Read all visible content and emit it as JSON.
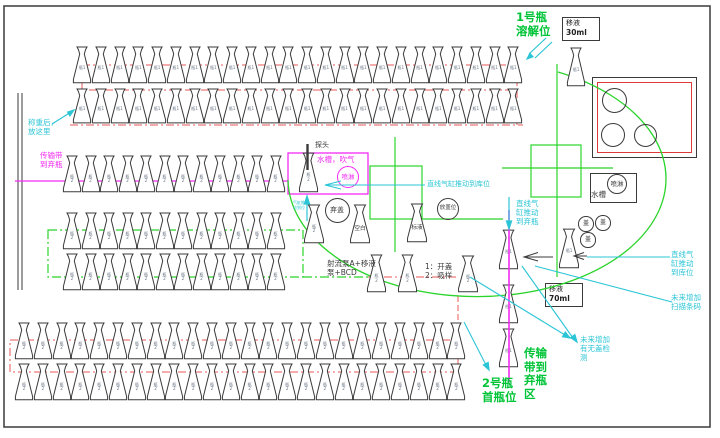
{
  "colors": {
    "black": "#3a3a3a",
    "red": "#ef8f8f",
    "red2": "#dd3a3a",
    "green": "#2bd42b",
    "greentext": "#00c437",
    "magenta": "#f32af3",
    "cyan": "#2cc5d6",
    "label": "#6a7585"
  },
  "frame": {
    "x": 4,
    "y": 6,
    "w": 706,
    "h": 421
  },
  "flask_rows": [
    {
      "name": "row-1",
      "x": 72,
      "y": 46,
      "count": 24,
      "pitch": 18.75,
      "fw": 20,
      "fh": 38,
      "label": "瓶1"
    },
    {
      "name": "row-2",
      "x": 72,
      "y": 88,
      "count": 24,
      "pitch": 18.75,
      "fw": 20,
      "fh": 36,
      "label": "瓶1"
    },
    {
      "name": "row-3",
      "x": 62,
      "y": 155,
      "count": 12,
      "pitch": 18.5,
      "fw": 20,
      "fh": 38,
      "label": "瓶\n2"
    },
    {
      "name": "row-4",
      "x": 62,
      "y": 212,
      "count": 12,
      "pitch": 18.5,
      "fw": 20,
      "fh": 38,
      "label": "瓶\n2"
    },
    {
      "name": "row-5",
      "x": 62,
      "y": 253,
      "count": 12,
      "pitch": 18.5,
      "fw": 20,
      "fh": 38,
      "label": "瓶\n2"
    },
    {
      "name": "row-6",
      "x": 14,
      "y": 322,
      "count": 24,
      "pitch": 18.8,
      "fw": 20,
      "fh": 38,
      "label": "瓶\n2"
    },
    {
      "name": "row-7",
      "x": 14,
      "y": 363,
      "count": 24,
      "pitch": 18.8,
      "fw": 20,
      "fh": 38,
      "label": "瓶\n2"
    }
  ],
  "flasks": [
    {
      "name": "flask-probe-station",
      "x": 298,
      "y": 152,
      "w": 21,
      "h": 41,
      "label": "瓶\n2"
    },
    {
      "name": "flask-wash-wait",
      "x": 303,
      "y": 204,
      "w": 22,
      "h": 40,
      "label": "瓶\n2"
    },
    {
      "name": "flask-blank",
      "x": 349,
      "y": 204,
      "w": 22,
      "h": 40,
      "label": "空白",
      "big": true
    },
    {
      "name": "flask-standard",
      "x": 406,
      "y": 203,
      "w": 22,
      "h": 40,
      "label": "标液",
      "big": true
    },
    {
      "name": "flask-carousel-1",
      "x": 366,
      "y": 254,
      "w": 21,
      "h": 39,
      "label": "瓶\n2"
    },
    {
      "name": "flask-carousel-2",
      "x": 397,
      "y": 254,
      "w": 21,
      "h": 39,
      "label": "瓶\n2"
    },
    {
      "name": "flask-open-aspirate",
      "x": 457,
      "y": 255,
      "w": 22,
      "h": 38,
      "label": "瓶\n2"
    },
    {
      "name": "flask-transfer",
      "x": 558,
      "y": 228,
      "w": 22,
      "h": 41,
      "label": "瓶1"
    },
    {
      "name": "flask-outfeed-1",
      "x": 498,
      "y": 229,
      "w": 21,
      "h": 41,
      "label": "瓶1"
    },
    {
      "name": "flask-outfeed-2",
      "x": 498,
      "y": 284,
      "w": 21,
      "h": 40,
      "label": "瓶1"
    },
    {
      "name": "flask-outfeed-3",
      "x": 498,
      "y": 328,
      "w": 21,
      "h": 40,
      "label": "瓶1"
    },
    {
      "name": "flask-dissolve",
      "x": 566,
      "y": 47,
      "w": 20,
      "h": 40,
      "label": "瓶1"
    }
  ],
  "boxes": [
    {
      "name": "cap-station-box",
      "x": 592,
      "y": 77,
      "w": 105,
      "h": 81,
      "border": "black",
      "bg": "#fff",
      "lines": []
    },
    {
      "name": "cap-station-inner",
      "x": 597,
      "y": 82,
      "w": 95,
      "h": 71,
      "border": "red2",
      "bg": "none",
      "lines": []
    },
    {
      "name": "water-tank-box",
      "x": 590,
      "y": 173,
      "w": 47,
      "h": 30,
      "border": "black",
      "bg": "#fff",
      "lines": []
    },
    {
      "name": "pipette-30ml-box",
      "x": 562,
      "y": 17,
      "w": 38,
      "h": 24,
      "border": "black",
      "bg": "#fff",
      "lines": [
        "移液",
        "30ml"
      ]
    },
    {
      "name": "pipette-70ml-box",
      "x": 545,
      "y": 283,
      "w": 38,
      "h": 24,
      "border": "black",
      "bg": "#fff",
      "lines": [
        "移液",
        "70ml"
      ]
    }
  ],
  "circles": [
    {
      "name": "discard-cap-circle",
      "cx": 337,
      "cy": 210,
      "r": 12.5,
      "label": "弃盖",
      "color": "black",
      "fs": 7
    },
    {
      "name": "place-cap-circle",
      "cx": 448,
      "cy": 209,
      "r": 11,
      "label": "放盖位",
      "color": "black",
      "fs": 5.6
    },
    {
      "name": "spray-circle-magenta",
      "cx": 348,
      "cy": 177,
      "r": 11,
      "label": "喷淋",
      "color": "magenta",
      "fs": 6.5
    },
    {
      "name": "spray-circle-black",
      "cx": 617,
      "cy": 184,
      "r": 10,
      "label": "喷淋",
      "color": "black",
      "fs": 6.5
    },
    {
      "name": "cap-circle-1",
      "cx": 586,
      "cy": 224,
      "r": 7.7,
      "label": "盖",
      "color": "black",
      "fs": 6
    },
    {
      "name": "cap-circle-2",
      "cx": 603,
      "cy": 223,
      "r": 7.7,
      "label": "盖",
      "color": "black",
      "fs": 6
    },
    {
      "name": "cap-circle-3",
      "cx": 588,
      "cy": 240,
      "r": 7.7,
      "label": "盖",
      "color": "black",
      "fs": 6
    },
    {
      "name": "station-circle-1",
      "cx": 614,
      "cy": 100,
      "r": 12.5,
      "label": "",
      "color": "black",
      "fs": 6
    },
    {
      "name": "station-circle-2",
      "cx": 613,
      "cy": 135,
      "r": 12,
      "label": "",
      "color": "black",
      "fs": 6
    },
    {
      "name": "station-circle-3",
      "cx": 645,
      "cy": 135,
      "r": 11.5,
      "label": "",
      "color": "black",
      "fs": 6
    }
  ],
  "annotations": [
    {
      "name": "note-weigh-here",
      "x": 28,
      "y": 118,
      "text": "称重后，\n放这里",
      "color": "cyan",
      "fs": 7.5
    },
    {
      "name": "note-belt-discard-left",
      "x": 40,
      "y": 151,
      "text": "传输带\n到弃瓶",
      "color": "magenta",
      "fs": 7.5
    },
    {
      "name": "note-bottle1-dissolve",
      "x": 516,
      "y": 11,
      "text": "1号瓶\n溶解位",
      "color": "greentext",
      "fs": 11.5,
      "lh": 13.5,
      "bold": true
    },
    {
      "name": "note-probe",
      "x": 315,
      "y": 141,
      "text": "探头",
      "color": "black",
      "fs": 7
    },
    {
      "name": "note-watertank-blow",
      "x": 317,
      "y": 155,
      "text": "水槽，吹气",
      "color": "magenta",
      "fs": 7.5
    },
    {
      "name": "note-cyl-push-store-top",
      "x": 427,
      "y": 180,
      "text": "直线气缸推动到库位",
      "color": "cyan",
      "fs": 7
    },
    {
      "name": "note-cyl-in-place-tiny",
      "x": 293,
      "y": 201,
      "text": "气缸推\n动到位",
      "color": "cyan",
      "fs": 4,
      "lh": 4.8
    },
    {
      "name": "note-jet-pump",
      "x": 327,
      "y": 259,
      "text": "射流泵A+移液\n泵+BCD",
      "color": "black",
      "fs": 7.5
    },
    {
      "name": "note-open-aspirate",
      "x": 425,
      "y": 262,
      "text": "1：开盖\n2：吸样",
      "color": "black",
      "fs": 7.5
    },
    {
      "name": "note-cyl-push-discard",
      "x": 516,
      "y": 199,
      "text": "直线气\n缸推动\n到弃瓶",
      "color": "cyan",
      "fs": 7.5
    },
    {
      "name": "note-cyl-push-store-right",
      "x": 671,
      "y": 250,
      "text": "直线气\n缸推动\n到库位",
      "color": "cyan",
      "fs": 7.5
    },
    {
      "name": "note-water-tank",
      "x": 591,
      "y": 190,
      "text": "水槽",
      "color": "black",
      "fs": 7.5
    },
    {
      "name": "note-future-barcode",
      "x": 671,
      "y": 293,
      "text": "未来增加\n扫描条码",
      "color": "cyan",
      "fs": 7.5
    },
    {
      "name": "note-future-cap-detect",
      "x": 580,
      "y": 335,
      "text": "未来增加\n有无盖检\n测",
      "color": "cyan",
      "fs": 7.5
    },
    {
      "name": "note-bottle2-first",
      "x": 482,
      "y": 377,
      "text": "2号瓶\n首瓶位",
      "color": "greentext",
      "fs": 11.5,
      "lh": 13.5,
      "bold": true
    },
    {
      "name": "note-belt-discard-area",
      "x": 524,
      "y": 347,
      "text": "传输\n带到\n弃瓶\n区",
      "color": "greentext",
      "fs": 11.5,
      "lh": 13.5,
      "bold": true
    }
  ],
  "shapes_under": [
    {
      "name": "outer-frame",
      "t": "rect",
      "x": 4,
      "y": 6,
      "w": 706,
      "h": 421,
      "color": "black",
      "sw": 1.5
    },
    {
      "name": "left-track-line-1",
      "t": "line",
      "x1": 18,
      "y1": 93,
      "x2": 18,
      "y2": 290,
      "color": "black",
      "sw": 1
    },
    {
      "name": "left-track-line-2",
      "t": "line",
      "x1": 22,
      "y1": 93,
      "x2": 22,
      "y2": 290,
      "color": "black",
      "sw": 1
    },
    {
      "name": "red-loop-top",
      "t": "rect",
      "x": 82,
      "y": 65,
      "w": 435,
      "h": 25,
      "color": "red",
      "sw": 1.5,
      "dash": "8 3 2 3"
    },
    {
      "name": "red-line-row2",
      "t": "line",
      "x1": 70,
      "y1": 125,
      "x2": 523,
      "y2": 125,
      "color": "red",
      "sw": 1.5,
      "dash": "8 3 2 3"
    },
    {
      "name": "red-drop-right",
      "t": "line",
      "x1": 517,
      "y1": 90,
      "x2": 517,
      "y2": 125,
      "color": "red",
      "sw": 1.5,
      "dash": "8 3 2 3"
    },
    {
      "name": "red-loop-bottom",
      "t": "rect",
      "x": 10,
      "y": 340,
      "w": 448,
      "h": 32,
      "color": "red",
      "sw": 1.5,
      "dash": "8 3 2 3"
    },
    {
      "name": "red-transfer-vline",
      "t": "line",
      "x1": 458,
      "y1": 296,
      "x2": 458,
      "y2": 340,
      "color": "red",
      "sw": 1.5,
      "dash": "6 3"
    },
    {
      "name": "red-transfer-hline",
      "t": "line",
      "x1": 368,
      "y1": 277,
      "x2": 458,
      "y2": 277,
      "color": "red",
      "sw": 1.5,
      "dash": "8 3 2 3"
    },
    {
      "name": "green-vline-dissolve",
      "t": "line",
      "x1": 557,
      "y1": 64,
      "x2": 557,
      "y2": 277,
      "color": "green",
      "sw": 1.2
    },
    {
      "name": "green-square-right",
      "t": "rect",
      "x": 531,
      "y": 145,
      "w": 50,
      "h": 52,
      "color": "green",
      "sw": 1.2
    },
    {
      "name": "green-hline-right",
      "t": "line",
      "x1": 502,
      "y1": 168,
      "x2": 613,
      "y2": 168,
      "color": "green",
      "sw": 1.2
    },
    {
      "name": "green-square-left",
      "t": "rect",
      "x": 370,
      "y": 166,
      "w": 52,
      "h": 53,
      "color": "green",
      "sw": 1.2
    },
    {
      "name": "green-vline-left",
      "t": "line",
      "x1": 395,
      "y1": 137,
      "x2": 395,
      "y2": 252,
      "color": "green",
      "sw": 1.2
    },
    {
      "name": "green-hline-left",
      "t": "line",
      "x1": 422,
      "y1": 219,
      "x2": 503,
      "y2": 219,
      "color": "green",
      "sw": 1.2
    },
    {
      "name": "green-dash-rect",
      "t": "rect",
      "x": 48,
      "y": 230,
      "w": 255,
      "h": 47,
      "color": "green",
      "sw": 1.2,
      "dash": "9 3 2 3"
    },
    {
      "name": "green-dash-ext",
      "t": "line",
      "x1": 303,
      "y1": 277,
      "x2": 368,
      "y2": 277,
      "color": "green",
      "sw": 1.2,
      "dash": "9 3 2 3"
    },
    {
      "name": "magenta-belt-line",
      "t": "line",
      "x1": 15,
      "y1": 181,
      "x2": 288,
      "y2": 181,
      "color": "magenta",
      "sw": 1.2
    },
    {
      "name": "magenta-station-box",
      "t": "rect",
      "x": 288,
      "y": 153,
      "w": 80,
      "h": 41,
      "color": "magenta",
      "sw": 1.3
    }
  ],
  "shapes_mid": [
    {
      "name": "carousel-ellipse-arc",
      "t": "path",
      "d": "M 288 180 A 189 118 0 1 0 558 72",
      "color": "green",
      "sw": 1.3
    }
  ],
  "shapes_over": [
    {
      "name": "pink-outfeed-line",
      "t": "line",
      "x1": 509,
      "y1": 210,
      "x2": 509,
      "y2": 382,
      "color": "magenta",
      "sw": 1.6
    },
    {
      "name": "probe-line",
      "t": "line",
      "x1": 307.5,
      "y1": 144,
      "x2": 307.5,
      "y2": 170,
      "color": "black",
      "sw": 2.4
    },
    {
      "name": "black-arrow1-line",
      "t": "line",
      "x1": 553,
      "y1": 257,
      "x2": 526,
      "y2": 257,
      "color": "black",
      "sw": 1
    },
    {
      "name": "black-arrow1-head",
      "t": "polyline",
      "pts": "538,252.5 524,257 538,261",
      "color": "black",
      "sw": 1
    },
    {
      "name": "black-arrow2-line",
      "t": "line",
      "x1": 587,
      "y1": 256,
      "x2": 577,
      "y2": 256,
      "color": "black",
      "sw": 1
    },
    {
      "name": "black-arrow2-head",
      "t": "polyline",
      "pts": "584,252.5 574,256 584,259.5",
      "color": "black",
      "sw": 1
    },
    {
      "name": "weigh-arrow-line",
      "t": "line",
      "x1": 52,
      "y1": 124,
      "x2": 71,
      "y2": 112,
      "color": "cyan",
      "sw": 1.2
    },
    {
      "name": "weigh-arrow-head",
      "t": "polygon",
      "pts": "74,110 67.7,112.1 69.9,115.9",
      "color": "cyan"
    },
    {
      "name": "dissolve-arrow-l1",
      "t": "line",
      "x1": 546,
      "y1": 38,
      "x2": 529,
      "y2": 54,
      "color": "cyan",
      "sw": 1.2
    },
    {
      "name": "dissolve-arrow-l2",
      "t": "line",
      "x1": 552,
      "y1": 42,
      "x2": 535,
      "y2": 58,
      "color": "cyan",
      "sw": 1.2
    },
    {
      "name": "dissolve-arrow-head",
      "t": "polygon",
      "pts": "527,59 533,56.7 529.9,53.3",
      "color": "cyan"
    },
    {
      "name": "push-store-line",
      "t": "line",
      "x1": 425,
      "y1": 185,
      "x2": 326,
      "y2": 185,
      "color": "cyan",
      "sw": 1.1
    },
    {
      "name": "push-store-head",
      "t": "polyline",
      "pts": "341,181 325,185 341,189",
      "color": "cyan",
      "sw": 1.1
    },
    {
      "name": "down-arrow-line",
      "t": "line",
      "x1": 509,
      "y1": 197,
      "x2": 509,
      "y2": 224,
      "color": "cyan",
      "sw": 1.2
    },
    {
      "name": "down-arrow-head",
      "t": "polygon",
      "pts": "509,229 506.4,221 511.6,221",
      "color": "cyan"
    },
    {
      "name": "up-arrow-line",
      "t": "line",
      "x1": 307,
      "y1": 221,
      "x2": 307,
      "y2": 200,
      "color": "cyan",
      "sw": 1.2
    },
    {
      "name": "up-arrow-head",
      "t": "polygon",
      "pts": "307,196 304.4,204 309.6,204",
      "color": "cyan"
    },
    {
      "name": "leader-capdetect-1",
      "t": "line",
      "x1": 522,
      "y1": 266,
      "x2": 573,
      "y2": 338,
      "color": "cyan",
      "sw": 1.1
    },
    {
      "name": "leader-capdetect-1h",
      "t": "polygon",
      "pts": "577,342 574.9,334.6 570.7,337.6",
      "color": "cyan"
    },
    {
      "name": "leader-capdetect-2",
      "t": "line",
      "x1": 470,
      "y1": 277,
      "x2": 565,
      "y2": 335,
      "color": "cyan",
      "sw": 1.1
    },
    {
      "name": "leader-capdetect-2h",
      "t": "polygon",
      "pts": "570,338 565.3,332.1 562.5,336.7",
      "color": "cyan"
    },
    {
      "name": "leader-barcode",
      "t": "line",
      "x1": 535,
      "y1": 266,
      "x2": 672,
      "y2": 302,
      "color": "cyan",
      "sw": 1.1
    },
    {
      "name": "leader-first-bottle",
      "t": "line",
      "x1": 464,
      "y1": 322,
      "x2": 486,
      "y2": 365,
      "color": "cyan",
      "sw": 1.1
    },
    {
      "name": "leader-first-bottle-h",
      "t": "polygon",
      "pts": "489,370 488.2,362.4 483.4,364.9",
      "color": "cyan"
    },
    {
      "name": "store-right-line",
      "t": "line",
      "x1": 587,
      "y1": 257,
      "x2": 670,
      "y2": 257,
      "color": "cyan",
      "sw": 1.1
    }
  ]
}
